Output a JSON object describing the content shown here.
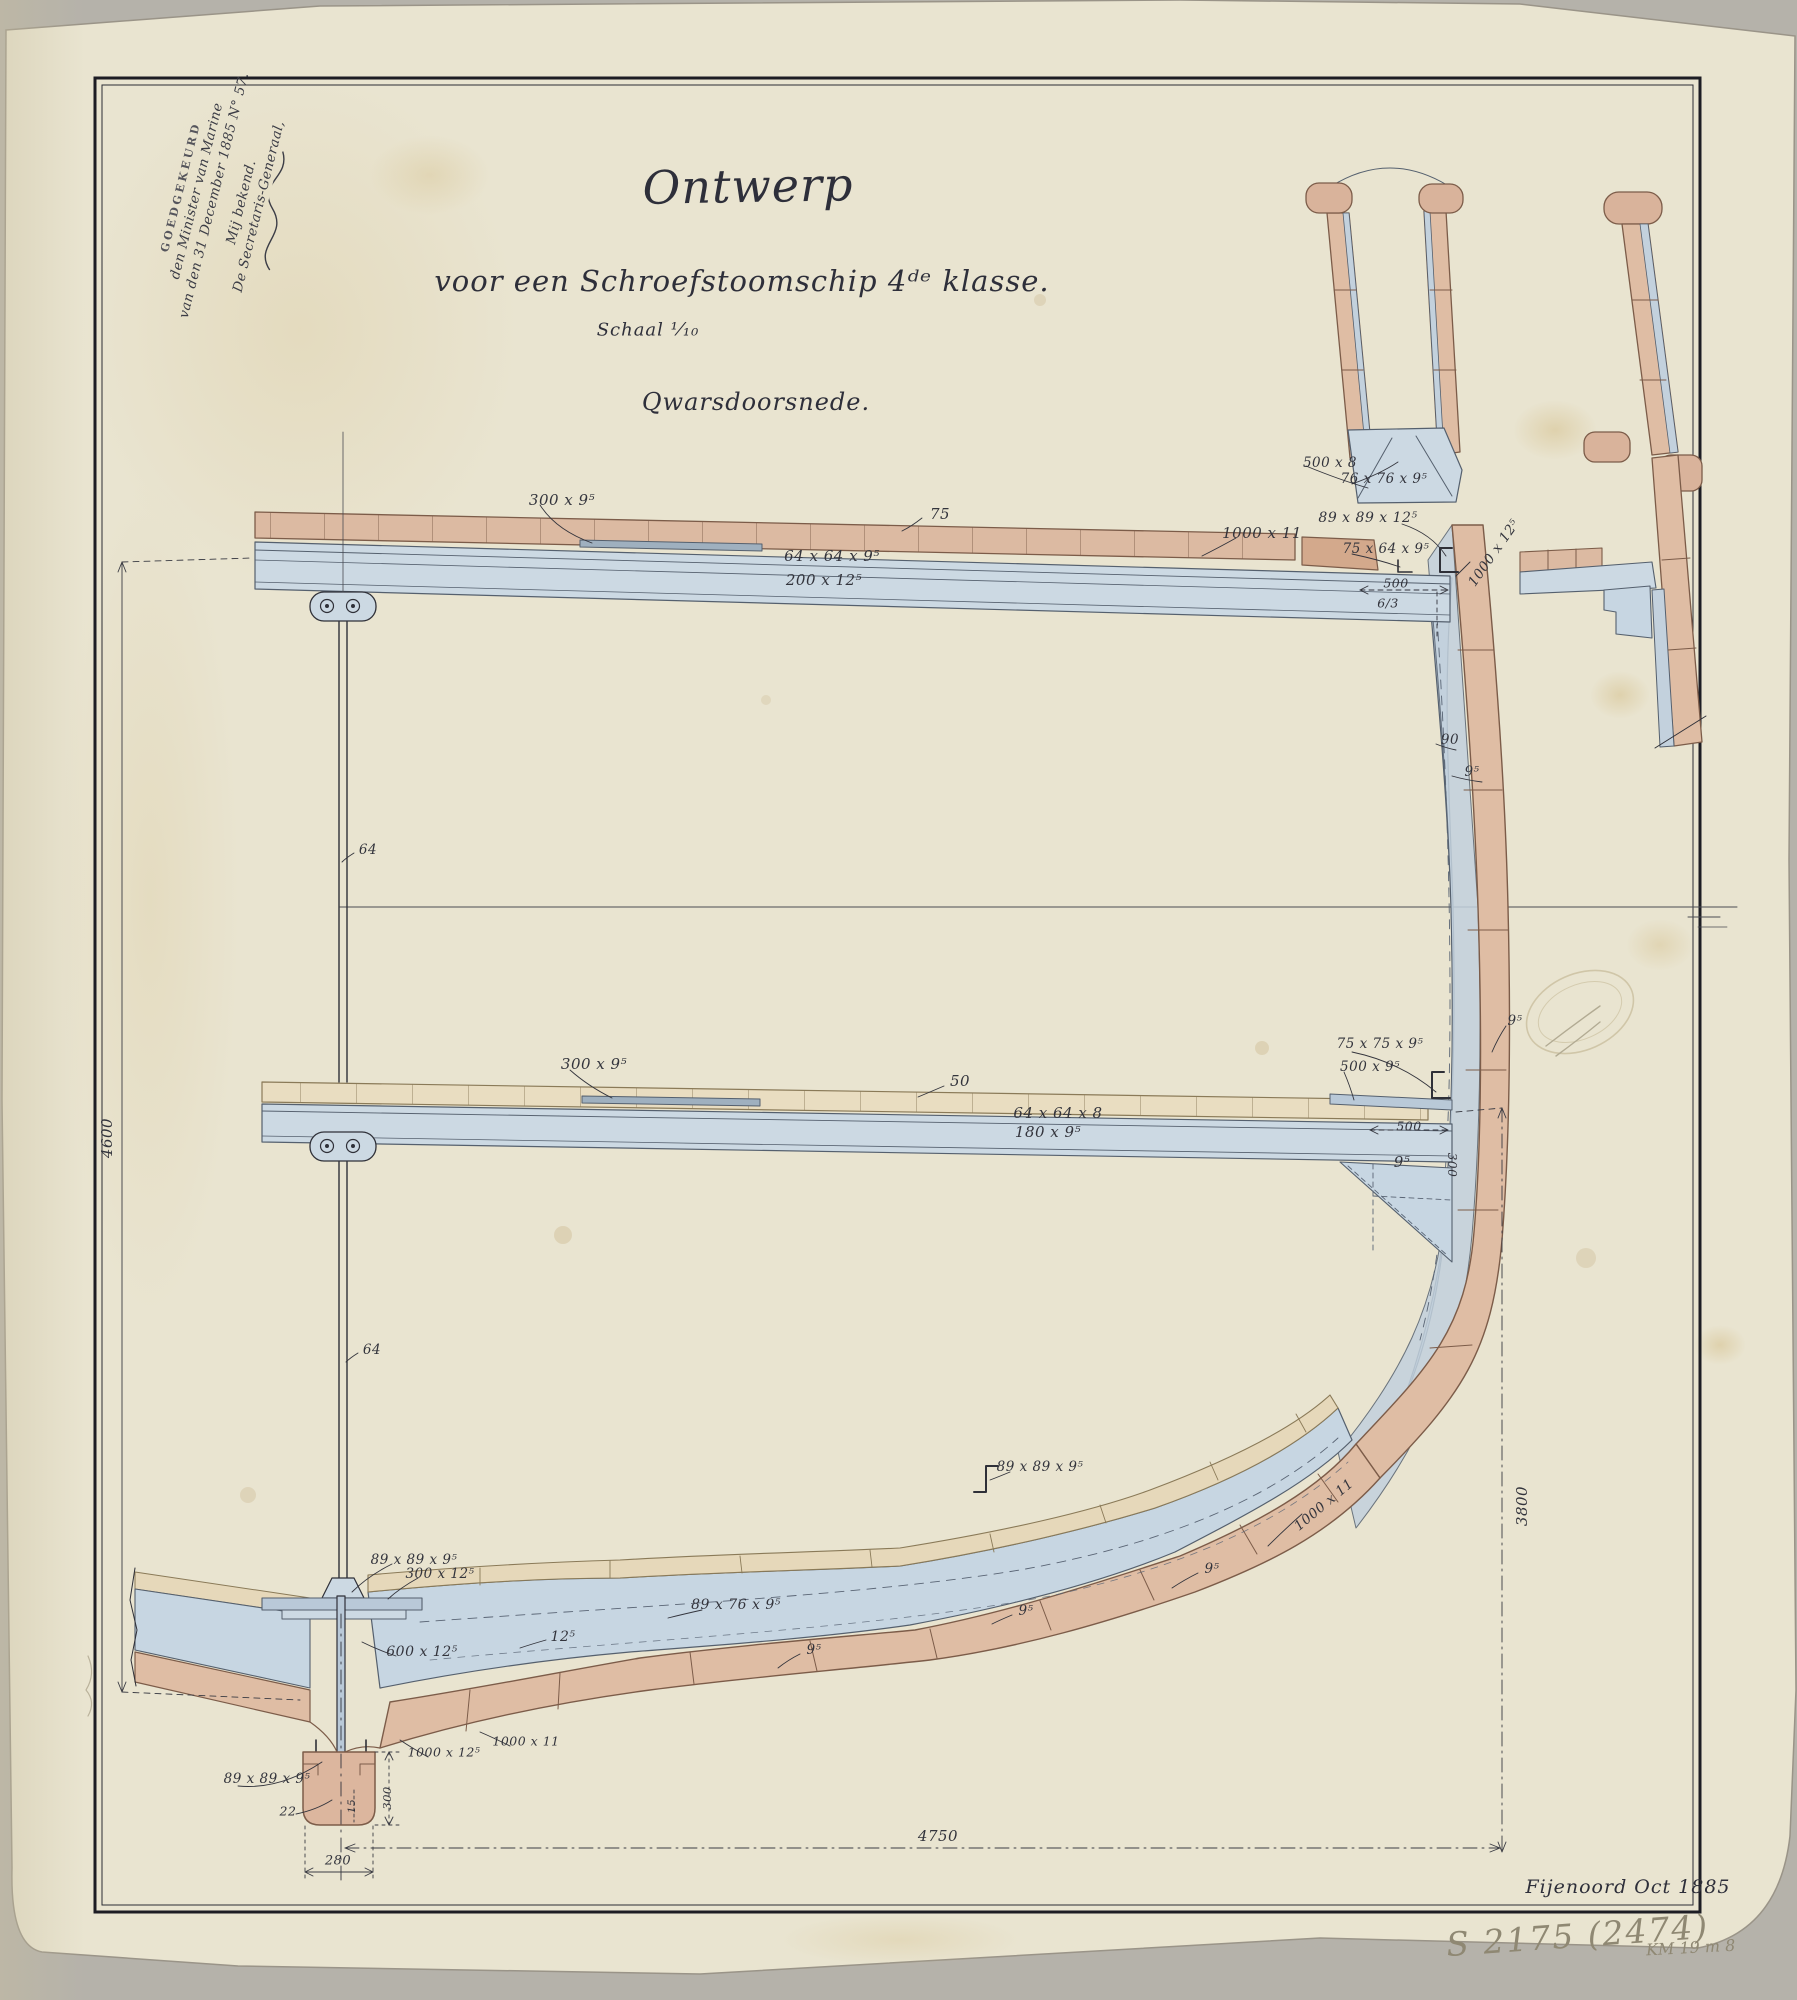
{
  "document": {
    "kind": "ship construction drawing (cross-section), ink and wash on aged paper",
    "title": "Ontwerp",
    "subtitle": "voor een Schroefstoomschip 4ᵈᵉ klasse.",
    "scale_note": "Schaal ¹⁄₁₀",
    "view_label": "Qwarsdoorsnede.",
    "signature_place_date": "Fijenoord      Oct 1885",
    "approval_stamp": {
      "line1": "GOEDGEKEURD",
      "line2": "den Minister van Marine",
      "line3": "van den 31 December 1885 N° 57.",
      "line4": "Mij bekend.",
      "line5": "De Secretaris-Generaal,"
    },
    "pencil_marks": {
      "inventory": "S 2175 (2474)",
      "archive": "KM 19 m 8"
    }
  },
  "colors": {
    "paper": "#e9e4d0",
    "paper_aged": "#d9d2b6",
    "photo_background": "#b5b2aa",
    "ink": "#2f3038",
    "steel_wash": "#ccd9e3",
    "wood_wash_pink": "#dfbda4",
    "wood_wash_cream": "#e9ddc1",
    "pencil": "#8f8873"
  },
  "labels": [
    {
      "t": "300 x 9⁵",
      "x": 562,
      "y": 500,
      "s": 15
    },
    {
      "t": "75",
      "x": 940,
      "y": 514,
      "s": 15
    },
    {
      "t": "64 x 64 x 9⁵",
      "x": 832,
      "y": 556,
      "s": 15
    },
    {
      "t": "200 x 12⁵",
      "x": 824,
      "y": 580,
      "s": 15
    },
    {
      "t": "1000 x 11",
      "x": 1262,
      "y": 533,
      "s": 15
    },
    {
      "t": "89 x 89 x 12⁵",
      "x": 1368,
      "y": 518,
      "s": 14
    },
    {
      "t": "75 x 64 x 9⁵",
      "x": 1386,
      "y": 549,
      "s": 13.5
    },
    {
      "t": "500",
      "x": 1396,
      "y": 583,
      "s": 12.5
    },
    {
      "t": "6/3",
      "x": 1388,
      "y": 603,
      "s": 12.5
    },
    {
      "t": "500 x 8",
      "x": 1330,
      "y": 463,
      "s": 13.5
    },
    {
      "t": "76 x 76 x 9⁵",
      "x": 1384,
      "y": 479,
      "s": 13.5
    },
    {
      "t": "1000 x 12⁵",
      "x": 1494,
      "y": 553,
      "s": 13.5,
      "r": -55
    },
    {
      "t": "90",
      "x": 1450,
      "y": 740,
      "s": 13.5
    },
    {
      "t": "9⁵",
      "x": 1472,
      "y": 772,
      "s": 13.5
    },
    {
      "t": "64",
      "x": 368,
      "y": 850,
      "s": 13.5
    },
    {
      "t": "64",
      "x": 372,
      "y": 1350,
      "s": 13.5
    },
    {
      "t": "300 x 9⁵",
      "x": 594,
      "y": 1064,
      "s": 15
    },
    {
      "t": "50",
      "x": 960,
      "y": 1081,
      "s": 15
    },
    {
      "t": "64 x 64 x 8",
      "x": 1058,
      "y": 1113,
      "s": 15
    },
    {
      "t": "180 x 9⁵",
      "x": 1048,
      "y": 1132,
      "s": 15
    },
    {
      "t": "75 x 75 x 9⁵",
      "x": 1380,
      "y": 1044,
      "s": 13.5
    },
    {
      "t": "500 x 9⁵",
      "x": 1370,
      "y": 1067,
      "s": 13.5
    },
    {
      "t": "9⁵",
      "x": 1515,
      "y": 1021,
      "s": 13.5
    },
    {
      "t": "500",
      "x": 1409,
      "y": 1126,
      "s": 12.5
    },
    {
      "t": "9⁵",
      "x": 1402,
      "y": 1162,
      "s": 15
    },
    {
      "t": "300",
      "x": 1452,
      "y": 1165,
      "s": 12,
      "r": 90
    },
    {
      "t": "89 x 89 x 9⁵",
      "x": 1040,
      "y": 1467,
      "s": 13.5
    },
    {
      "t": "1000 x 11",
      "x": 1324,
      "y": 1505,
      "s": 13.5,
      "r": -40
    },
    {
      "t": "9⁵",
      "x": 1212,
      "y": 1569,
      "s": 13.5
    },
    {
      "t": "9⁵",
      "x": 1026,
      "y": 1611,
      "s": 13.5
    },
    {
      "t": "89 x 76 x 9⁵",
      "x": 736,
      "y": 1605,
      "s": 14
    },
    {
      "t": "9⁵",
      "x": 814,
      "y": 1650,
      "s": 13.5
    },
    {
      "t": "89 x 89 x 9⁵",
      "x": 414,
      "y": 1560,
      "s": 13.5
    },
    {
      "t": "300 x 12⁵",
      "x": 440,
      "y": 1574,
      "s": 13.5
    },
    {
      "t": "600 x 12⁵",
      "x": 422,
      "y": 1652,
      "s": 14
    },
    {
      "t": "12⁵",
      "x": 563,
      "y": 1637,
      "s": 14
    },
    {
      "t": "89 x 89 x 9⁵",
      "x": 267,
      "y": 1779,
      "s": 13.5
    },
    {
      "t": "22",
      "x": 288,
      "y": 1811,
      "s": 12.5
    },
    {
      "t": "1000 x 12⁵",
      "x": 444,
      "y": 1752,
      "s": 12.5
    },
    {
      "t": "1000 x 11",
      "x": 526,
      "y": 1741,
      "s": 12.5
    },
    {
      "t": "300",
      "x": 387,
      "y": 1798,
      "s": 11.5,
      "r": -90
    },
    {
      "t": "15",
      "x": 352,
      "y": 1806,
      "s": 10.5,
      "r": -90
    },
    {
      "t": "280",
      "x": 338,
      "y": 1861,
      "s": 13
    },
    {
      "t": "4600",
      "x": 107,
      "y": 1138,
      "s": 15,
      "r": -90
    },
    {
      "t": "3800",
      "x": 1522,
      "y": 1506,
      "s": 15,
      "r": -90
    },
    {
      "t": "4750",
      "x": 938,
      "y": 1836,
      "s": 15
    }
  ]
}
